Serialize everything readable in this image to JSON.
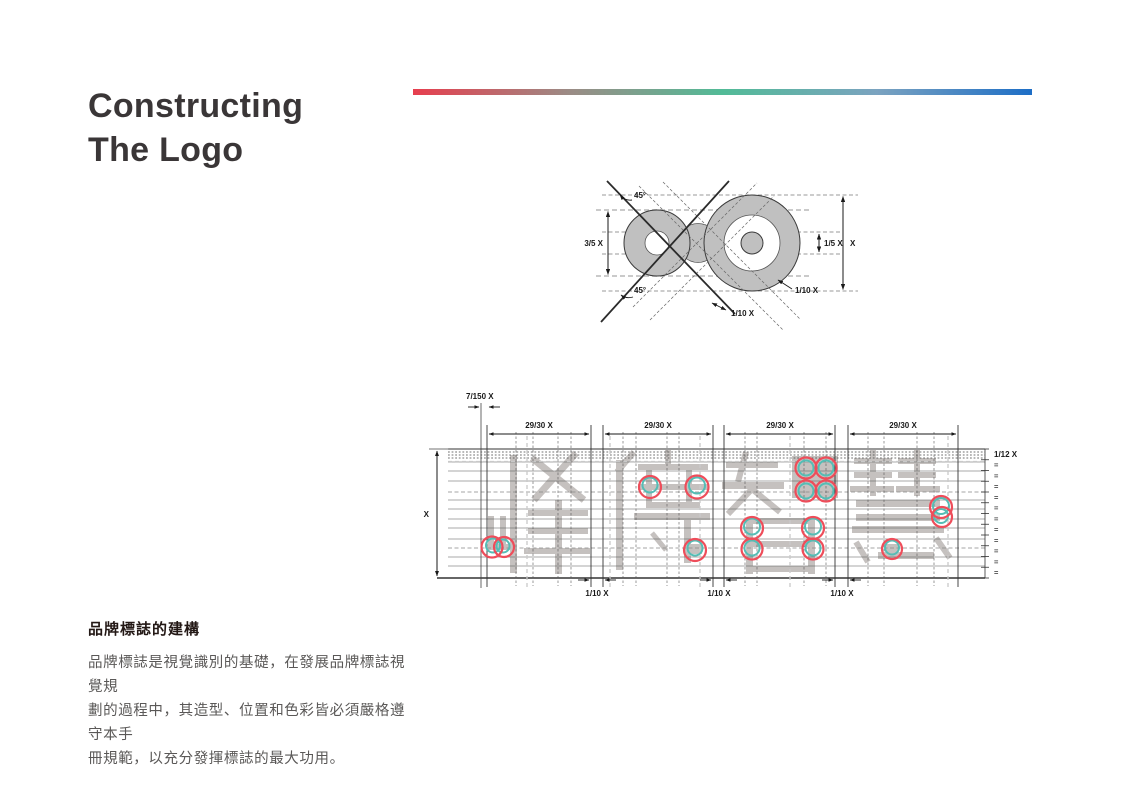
{
  "page": {
    "title_line1": "Constructing",
    "title_line2": "The Logo"
  },
  "gradient_bar": {
    "colors": [
      "#E73E4E",
      "#9C8B85",
      "#52BB97",
      "#7BA3C0",
      "#1D6EC6"
    ]
  },
  "colors": {
    "accent_red": "#EE4D5A",
    "accent_teal": "#55BDB5",
    "glyph_gray": "#C5C1BF",
    "diagram_fill_gray": "#C0C0C0",
    "title_color": "#3A3637"
  },
  "logo_diagram": {
    "labels": {
      "angle_top": "45°",
      "angle_bottom": "45°",
      "small_circle_height": "3/5 X",
      "center_dot_diameter": "1/5 X",
      "total_height": "X",
      "stroke_offset": "1/10 X",
      "diagonal_gap": "1/10 X"
    }
  },
  "grid_diagram": {
    "logotype_characters": "峰傳智慧",
    "labels": {
      "stroke_width": "7/150 X",
      "char_widths": [
        "29/30 X",
        "29/30 X",
        "29/30 X",
        "29/30 X"
      ],
      "row_unit": "1/12 X",
      "total_height": "X",
      "char_gaps": [
        "1/10 X",
        "1/10 X",
        "1/10 X"
      ],
      "equal_mark": "="
    }
  },
  "description": {
    "heading": "品牌標誌的建構",
    "lines": [
      "品牌標誌是視覺識別的基礎，在發展品牌標誌視覺規",
      "劃的過程中，其造型、位置和色彩皆必須嚴格遵守本手",
      "冊規範，以充分發揮標誌的最大功用。"
    ]
  }
}
